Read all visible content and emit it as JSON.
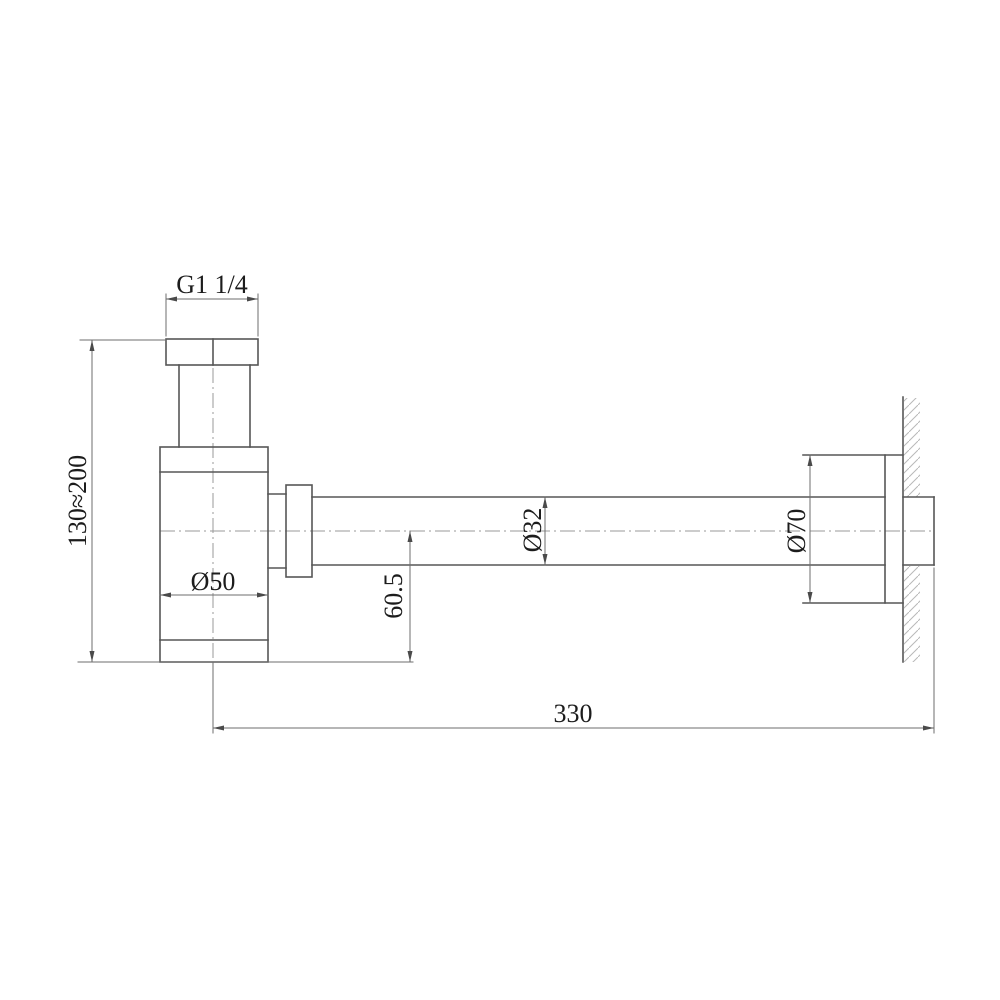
{
  "drawing": {
    "kind": "technical-dimension-drawing",
    "subject": "bottle-trap-siphon-side-view",
    "colors": {
      "background": "#ffffff",
      "structure_line": "#565656",
      "dimension_line": "#6e6e6e",
      "centerline": "#9a9a9a",
      "hatch": "#b8b8b8",
      "text": "#1c1c1c"
    },
    "labels": {
      "thread_size": "G1 1/4",
      "height_range": "130≈200",
      "body_diameter": "Ø50",
      "centerline_to_bottom": "60.5",
      "pipe_diameter": "Ø32",
      "flange_diameter": "Ø70",
      "wall_to_trap_length": "330"
    }
  }
}
